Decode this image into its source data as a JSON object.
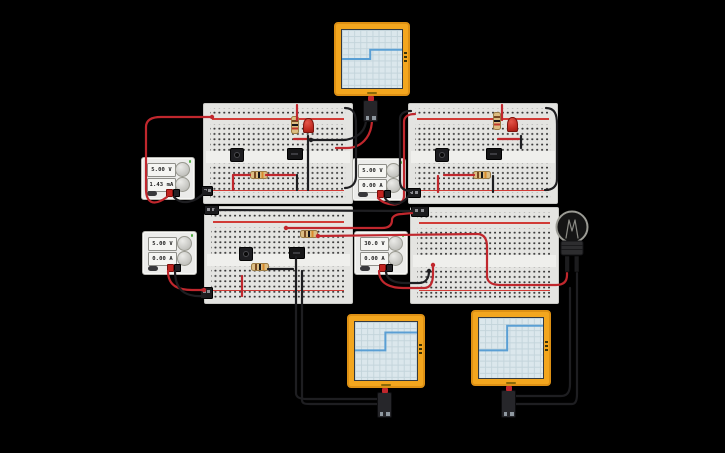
{
  "scene": {
    "background": "#000000"
  },
  "power_supplies": [
    {
      "label": "power-supply-1",
      "voltage": "5.00 V",
      "current": "1.43 mA"
    },
    {
      "label": "power-supply-2",
      "voltage": "5.00 V",
      "current": "0.00 A"
    },
    {
      "label": "power-supply-3",
      "voltage": "5.00 V",
      "current": "0.00 A"
    },
    {
      "label": "power-supply-4",
      "voltage": "30.0 V",
      "current": "0.00 A"
    }
  ],
  "oscilloscopes": [
    {
      "label": "oscilloscope-top",
      "trace": {
        "type": "step",
        "low_frac": 0.5,
        "high_frac": 0.34,
        "step_x_frac": 0.47
      }
    },
    {
      "label": "oscilloscope-bottom-left",
      "trace": {
        "type": "step",
        "low_frac": 0.49,
        "high_frac": 0.18,
        "step_x_frac": 0.49
      }
    },
    {
      "label": "oscilloscope-bottom-right",
      "trace": {
        "type": "step",
        "low_frac": 0.54,
        "high_frac": 0.13,
        "step_x_frac": 0.44
      }
    }
  ],
  "chart_data": [
    {
      "type": "line",
      "title": "oscilloscope-top step waveform",
      "x_frac": [
        0,
        0.47,
        0.47,
        1
      ],
      "y_frac_from_top": [
        0.5,
        0.5,
        0.34,
        0.34
      ],
      "note": "no axis tick labels visible on screen"
    },
    {
      "type": "line",
      "title": "oscilloscope-bottom-left step waveform",
      "x_frac": [
        0,
        0.49,
        0.49,
        1
      ],
      "y_frac_from_top": [
        0.49,
        0.49,
        0.18,
        0.18
      ],
      "note": "no axis tick labels visible on screen"
    },
    {
      "type": "line",
      "title": "oscilloscope-bottom-right step waveform",
      "x_frac": [
        0,
        0.44,
        0.44,
        1
      ],
      "y_frac_from_top": [
        0.54,
        0.54,
        0.13,
        0.13
      ],
      "note": "no axis tick labels visible on screen"
    }
  ],
  "colors": {
    "wire_red": "#c0272d",
    "wire_black": "#1e1e21",
    "scope_frame": "#f3a61e",
    "scope_trace": "#5a9fd4",
    "breadboard": "#e4e4e1"
  }
}
